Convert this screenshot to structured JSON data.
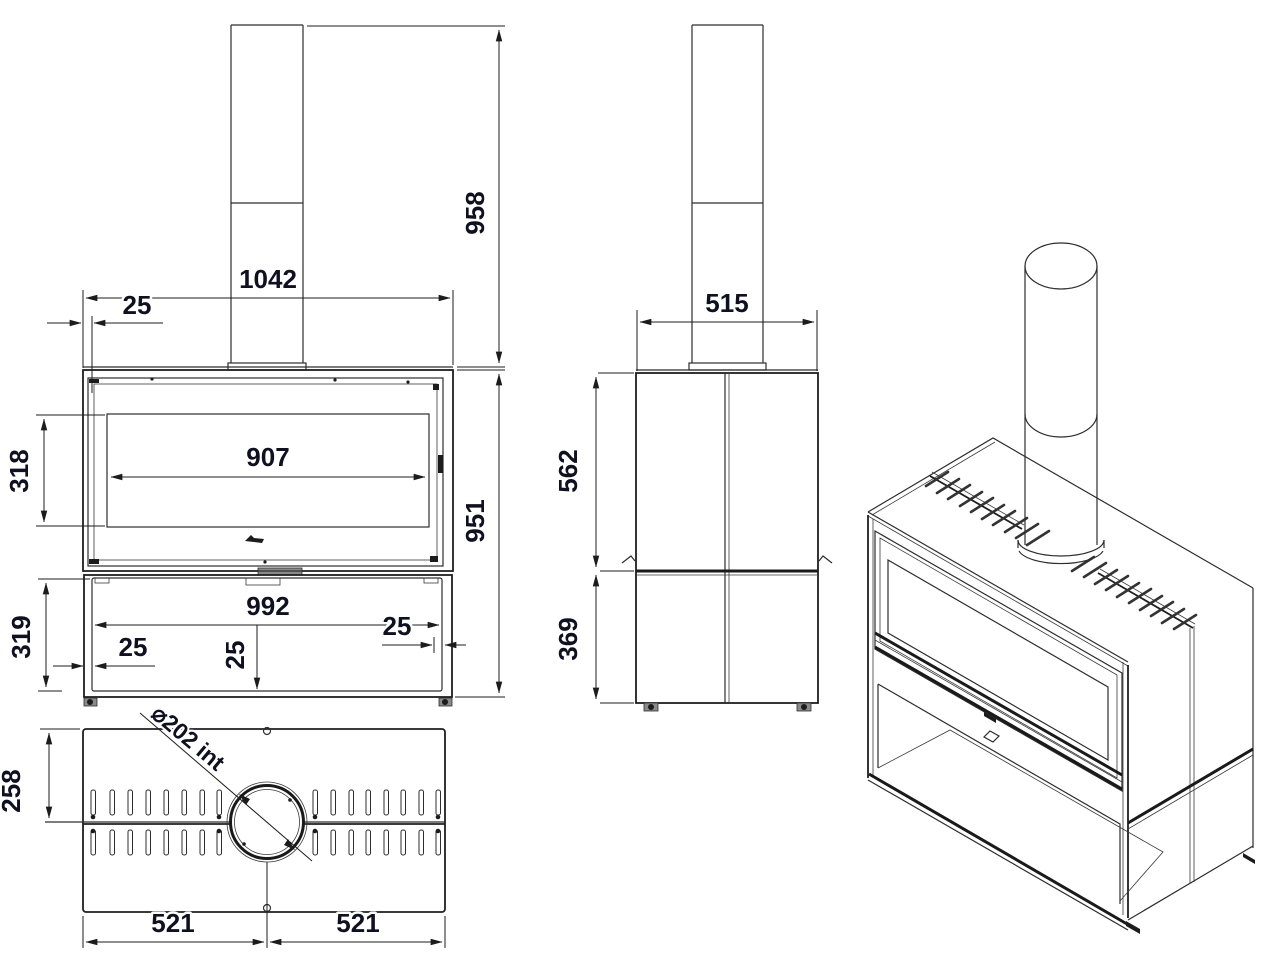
{
  "title": "Freestanding stove dimensional drawing",
  "colors": {
    "background": "#ffffff",
    "line": "#2d2d2d",
    "dim_text": "#101020"
  },
  "views": {
    "front": {
      "dims": {
        "chimney_height": "958",
        "overall_width": "1042",
        "door_inset_top": "25",
        "glass_width": "907",
        "glass_height": "318",
        "overall_height": "951",
        "compartment_width": "992",
        "compartment_height": "319",
        "inset_bottom_left": "25",
        "inset_bottom_center": "25",
        "inset_bottom_right": "25"
      }
    },
    "side": {
      "dims": {
        "depth": "515",
        "upper_height": "562",
        "base_height": "369"
      }
    },
    "top": {
      "dims": {
        "front_to_flue_center": "258",
        "flue_inner_diameter": "⌀202 int",
        "left_half_width": "521",
        "right_half_width": "521"
      }
    }
  }
}
